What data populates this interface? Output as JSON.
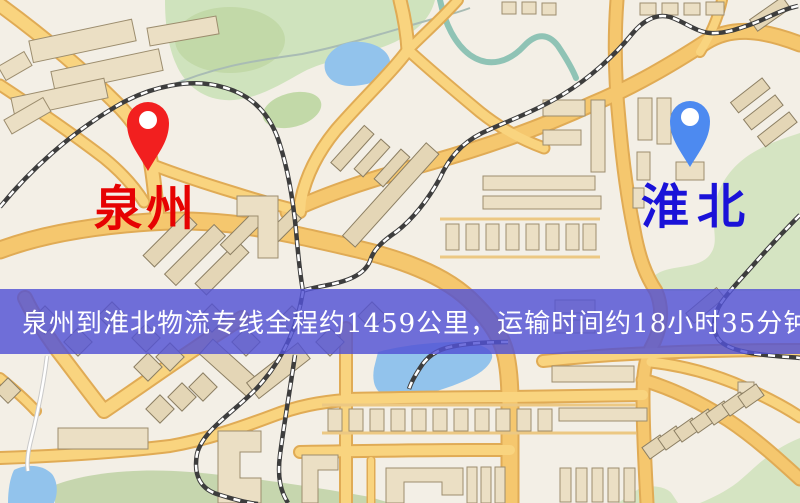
{
  "labels": {
    "origin": "泉州",
    "destination": "淮北",
    "origin_color": "#e60202",
    "destination_color": "#1a12d8"
  },
  "pins": {
    "origin_color": "#f21f1f",
    "destination_color": "#4d8af0",
    "hole_color": "#ffffff"
  },
  "banner": {
    "text": "泉州到淮北物流专线全程约1459公里，运输时间约18小时35分钟.",
    "background": "#5252d4",
    "opacity": "0.82",
    "text_color": "#ffffff"
  },
  "map_colors": {
    "background": "#f3efe6",
    "road_fill": "#f9d47f",
    "road_major_fill": "#f5c76e",
    "road_casing": "#e0ab55",
    "park": "#cfe3bd",
    "water": "#92c3ec",
    "building": "#ebdfc4",
    "railway": "#3d3d3d"
  }
}
